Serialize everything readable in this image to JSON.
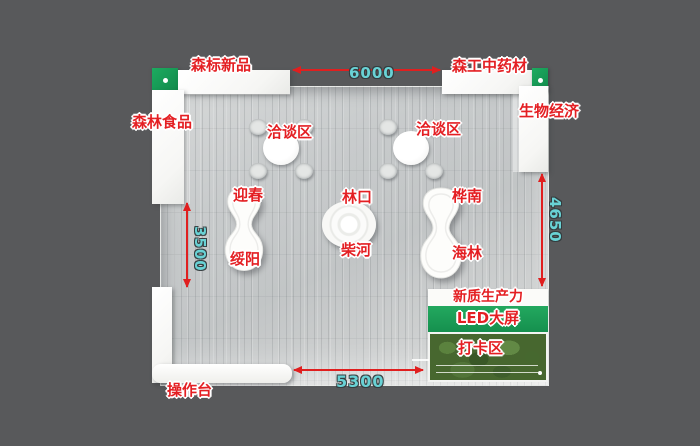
{
  "booth": {
    "shelves": {
      "top_left": "森标新品",
      "left": "森林食品",
      "top_right": "森工中药材",
      "right": "生物经济"
    },
    "counter_label": "操作台",
    "negotiation_zones": [
      "洽谈区",
      "洽谈区"
    ],
    "stands": {
      "left": {
        "top": "迎春",
        "bottom": "绥阳"
      },
      "center": {
        "top": "林口",
        "bottom": "柴河"
      },
      "right": {
        "top": "桦南",
        "bottom": "海林"
      }
    },
    "media_wall": {
      "banner": "新质生产力",
      "screen": "LED大屏",
      "photo_zone": "打卡区"
    },
    "dimensions": {
      "top": "6000",
      "left": "3500",
      "right": "4650",
      "bottom": "5300"
    },
    "colors": {
      "background": "#58595B",
      "floor": "#C7CACB",
      "wall": "#F8F8F6",
      "accent_green": "#1A9C57",
      "label_red": "#E41F23",
      "dimension_teal": "#69D2D5",
      "arrow_red": "#E01F1F",
      "greenery": "#47672F"
    }
  }
}
